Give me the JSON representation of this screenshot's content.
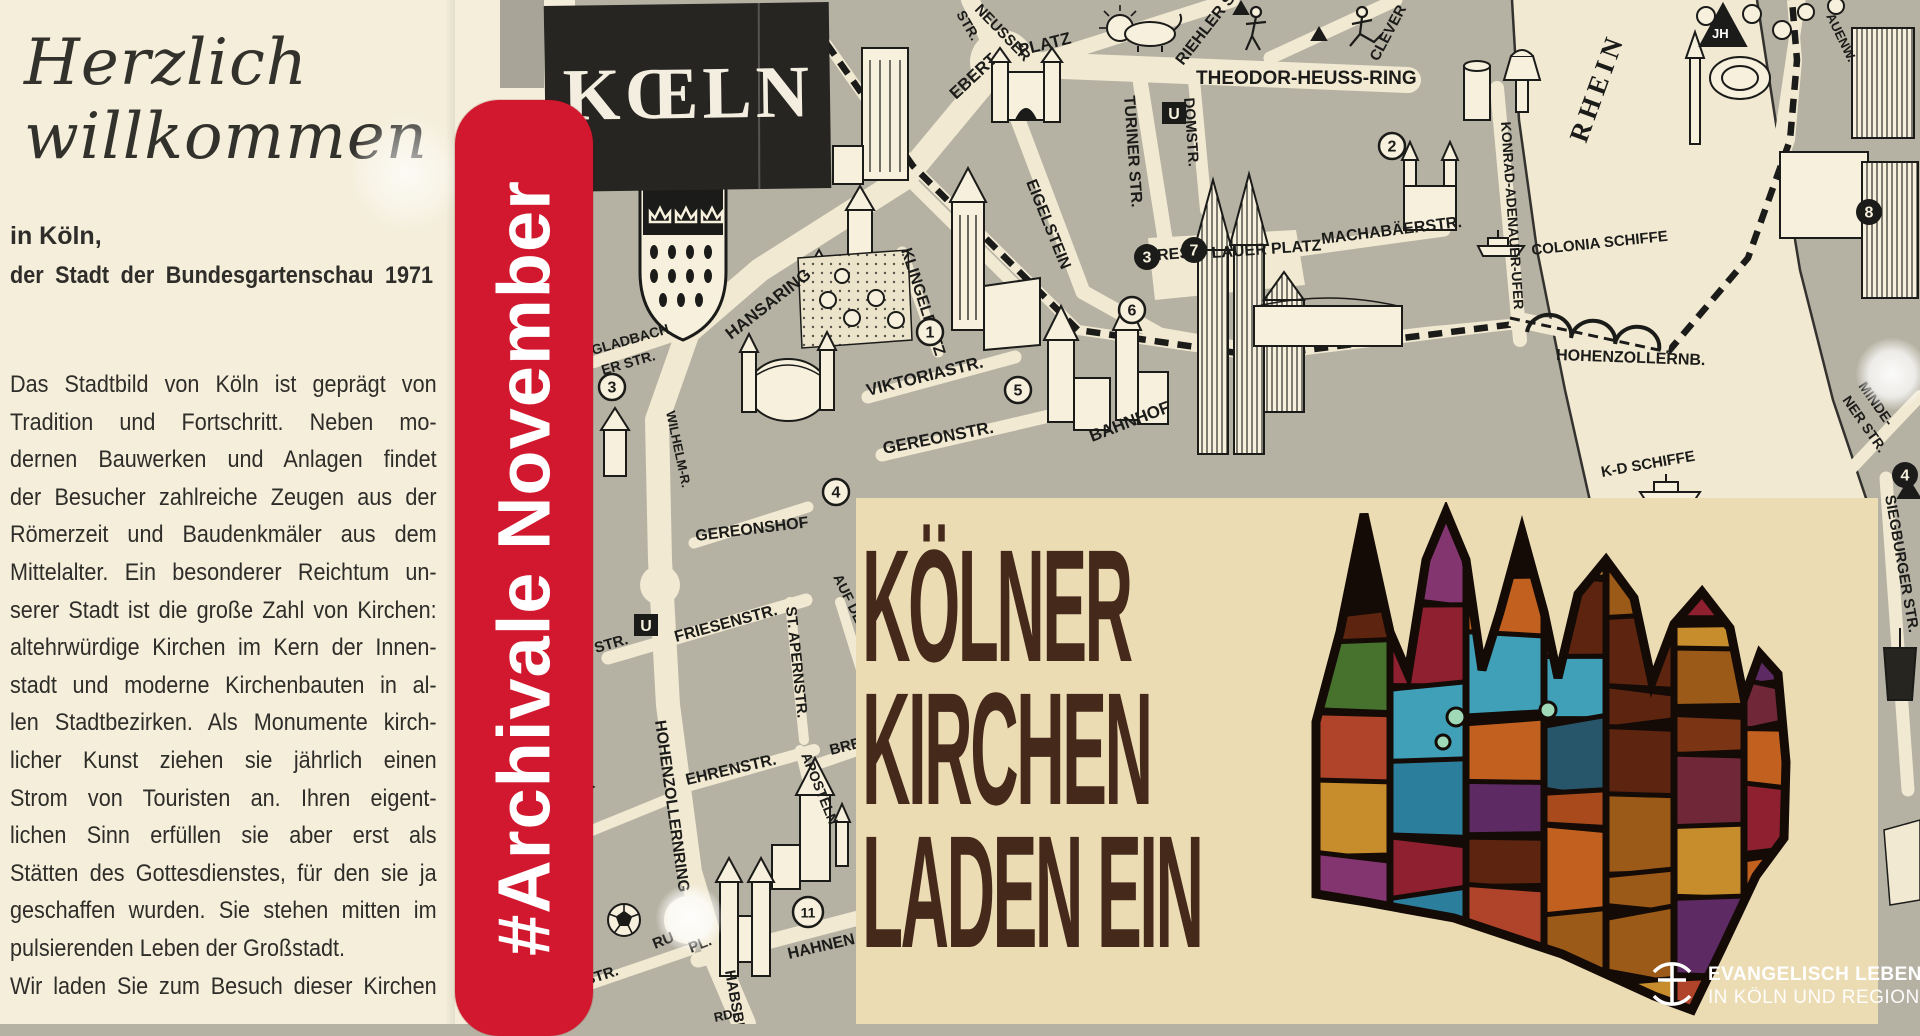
{
  "intro": {
    "headline_line1": "Herzlich",
    "headline_line2": "willkommen",
    "sub1": "in Köln,",
    "sub2": "der Stadt der Bundesgartenschau 1971",
    "body_lines": [
      "Das Stadtbild von Köln ist geprägt von",
      "Tradition und Fortschritt. Neben mo-",
      "dernen Bauwerken und Anlagen findet",
      "der Besucher zahlreiche Zeugen aus der",
      "Römerzeit und Baudenkmäler aus dem",
      "Mittelalter. Ein besonderer Reichtum un-",
      "serer Stadt ist die große Zahl von Kirchen:",
      "altehrwürdige Kirchen im Kern der Innen-",
      "stadt und moderne Kirchenbauten in al-",
      "len Stadtbezirken. Als Monumente kirch-",
      "licher Kunst ziehen sie jährlich einen",
      "Strom von Touristen an. Ihren eigent-",
      "lichen Sinn erfüllen sie aber erst als",
      "Stätten des Gottesdienstes, für den sie ja",
      "geschaffen wurden. Sie stehen mitten im",
      "pulsierenden Leben der Großstadt.",
      "Wir laden Sie zum Besuch dieser Kirchen"
    ]
  },
  "banner": {
    "text": "#Archivale November",
    "color": "#d2182e"
  },
  "map": {
    "logo_box": "KŒLN",
    "ink": "#1b1b19",
    "street_color": "#f1e9d2",
    "ground_color": "#b6b2a3",
    "labels": [
      {
        "t": "NEUSSER",
        "x": 974,
        "y": 10,
        "r": 46,
        "s": 15
      },
      {
        "t": "STR.",
        "x": 956,
        "y": 14,
        "r": 60,
        "s": 14
      },
      {
        "t": "EBERT",
        "x": 956,
        "y": 100,
        "r": -43,
        "s": 17
      },
      {
        "t": "PLATZ",
        "x": 1020,
        "y": 56,
        "r": -14,
        "s": 17
      },
      {
        "t": "RIEHLER STR.",
        "x": 1183,
        "y": 66,
        "r": -52,
        "s": 16
      },
      {
        "t": "THEODOR-HEUSS-RING",
        "x": 1196,
        "y": 84,
        "r": 0,
        "s": 19
      },
      {
        "t": "CLEVER",
        "x": 1378,
        "y": 62,
        "r": -62,
        "s": 15
      },
      {
        "t": "TURINER STR.",
        "x": 1124,
        "y": 96,
        "r": 86,
        "s": 16
      },
      {
        "t": "DOMSTR.",
        "x": 1184,
        "y": 98,
        "r": 86,
        "s": 15
      },
      {
        "t": "EIGELSTEIN",
        "x": 1026,
        "y": 182,
        "r": 68,
        "s": 16
      },
      {
        "t": "MACHABÄERSTR.",
        "x": 1322,
        "y": 244,
        "r": -7,
        "s": 16
      },
      {
        "t": "BRES",
        "x": 1146,
        "y": 261,
        "r": -4,
        "s": 16
      },
      {
        "t": "LAUER PLATZ",
        "x": 1212,
        "y": 258,
        "r": -4,
        "s": 16
      },
      {
        "t": "HANSARING",
        "x": 731,
        "y": 340,
        "r": -38,
        "s": 17
      },
      {
        "t": "KLINGELPÜTZ",
        "x": 901,
        "y": 250,
        "r": 72,
        "s": 16
      },
      {
        "t": "VIKTORIASTR.",
        "x": 868,
        "y": 396,
        "r": -14,
        "s": 17
      },
      {
        "t": "GEREONSTR.",
        "x": 884,
        "y": 454,
        "r": -11,
        "s": 17
      },
      {
        "t": "GEREONSHOF",
        "x": 696,
        "y": 541,
        "r": -7,
        "s": 16
      },
      {
        "t": "BAHNHOF",
        "x": 1092,
        "y": 442,
        "r": -21,
        "s": 17
      },
      {
        "t": "GLADBACH",
        "x": 593,
        "y": 355,
        "r": -16,
        "s": 14
      },
      {
        "t": "ER STR.",
        "x": 603,
        "y": 375,
        "r": -16,
        "s": 14
      },
      {
        "t": "WILHELM-R.",
        "x": 666,
        "y": 412,
        "r": 78,
        "s": 13
      },
      {
        "t": "STR.",
        "x": 596,
        "y": 653,
        "r": -16,
        "s": 15
      },
      {
        "t": "FRIESENSTR.",
        "x": 676,
        "y": 642,
        "r": -15,
        "s": 16
      },
      {
        "t": "ST. APERNSTR.",
        "x": 786,
        "y": 607,
        "r": 84,
        "s": 15
      },
      {
        "t": "AUF DEM BER",
        "x": 833,
        "y": 577,
        "r": 64,
        "s": 14
      },
      {
        "t": "HOHENZOLLERNRING",
        "x": 655,
        "y": 721,
        "r": 82,
        "s": 16
      },
      {
        "t": "EHRENSTR.",
        "x": 687,
        "y": 785,
        "r": -13,
        "s": 16
      },
      {
        "t": "RICHTER",
        "x": 538,
        "y": 820,
        "r": -30,
        "s": 15
      },
      {
        "t": "STR.",
        "x": 556,
        "y": 850,
        "r": -30,
        "s": 15
      },
      {
        "t": "BRE",
        "x": 831,
        "y": 755,
        "r": -14,
        "s": 15
      },
      {
        "t": "APOSTELN",
        "x": 801,
        "y": 755,
        "r": 68,
        "s": 14
      },
      {
        "t": "HAHNEN",
        "x": 789,
        "y": 959,
        "r": -13,
        "s": 16
      },
      {
        "t": "HABSBUR",
        "x": 725,
        "y": 971,
        "r": 80,
        "s": 15
      },
      {
        "t": "RU",
        "x": 655,
        "y": 949,
        "r": -22,
        "s": 15
      },
      {
        "t": "PL.",
        "x": 691,
        "y": 953,
        "r": -22,
        "s": 15
      },
      {
        "t": "ER STR.",
        "x": 563,
        "y": 993,
        "r": -18,
        "s": 15
      },
      {
        "t": "RD.",
        "x": 715,
        "y": 1022,
        "r": -12,
        "s": 13
      },
      {
        "t": "KONRAD-ADENAUER-UFER",
        "x": 1501,
        "y": 122,
        "r": 86,
        "s": 14
      },
      {
        "t": "COLONIA SCHIFFE",
        "x": 1532,
        "y": 255,
        "r": -6,
        "s": 15
      },
      {
        "t": "HOHENZOLLERNB.",
        "x": 1556,
        "y": 360,
        "r": 2,
        "s": 16
      },
      {
        "t": "K-D SCHIFFE",
        "x": 1602,
        "y": 477,
        "r": -10,
        "s": 15
      },
      {
        "t": "RHEIN",
        "x": 1586,
        "y": 144,
        "r": -70,
        "s": 27,
        "f": "serif",
        "ls": 5
      },
      {
        "t": "MINDE-",
        "x": 1858,
        "y": 386,
        "r": 55,
        "s": 14
      },
      {
        "t": "NER STR.",
        "x": 1842,
        "y": 400,
        "r": 55,
        "s": 14
      },
      {
        "t": "SIEGBURGER STR.",
        "x": 1885,
        "y": 496,
        "r": 80,
        "s": 15
      },
      {
        "t": "AUENW.",
        "x": 1826,
        "y": 16,
        "r": 64,
        "s": 13
      },
      {
        "t": "JH",
        "x": 1712,
        "y": 38,
        "r": 0,
        "s": 13,
        "c": "#ffffff"
      }
    ],
    "markers": [
      {
        "n": "1",
        "x": 930,
        "y": 332
      },
      {
        "n": "2",
        "x": 1392,
        "y": 146
      },
      {
        "n": "3",
        "x": 612,
        "y": 387
      },
      {
        "n": "4",
        "x": 836,
        "y": 492
      },
      {
        "n": "5",
        "x": 1018,
        "y": 390
      },
      {
        "n": "6",
        "x": 1132,
        "y": 310
      },
      {
        "n": "11",
        "x": 808,
        "y": 912
      },
      {
        "n": "3",
        "x": 1147,
        "y": 257,
        "b": 1
      },
      {
        "n": "7",
        "x": 1194,
        "y": 250,
        "b": 1
      },
      {
        "n": "8",
        "x": 1869,
        "y": 212,
        "b": 1
      },
      {
        "n": "4",
        "x": 1905,
        "y": 475,
        "b": 1
      },
      {
        "n": "U",
        "x": 1162,
        "y": 102,
        "u": 1
      },
      {
        "n": "U",
        "x": 634,
        "y": 614,
        "u": 1
      }
    ]
  },
  "panel": {
    "title_lines": [
      "KÖLNER",
      "KIRCHEN",
      "LADEN EIN"
    ],
    "bg": "#ecdcb4",
    "title_color": "#45291b",
    "glass_colors": [
      "#7b3514",
      "#a84a1c",
      "#c2611f",
      "#5d2410",
      "#2b7f9c",
      "#3fa0b8",
      "#5d2a63",
      "#83356f",
      "#8f2030",
      "#b0442a",
      "#c78d2c",
      "#46722e",
      "#27566b",
      "#9c5a18",
      "#702838"
    ]
  },
  "brand": {
    "line1": "EVANGELISCH LEBEN",
    "line2": "IN KÖLN UND REGION"
  }
}
